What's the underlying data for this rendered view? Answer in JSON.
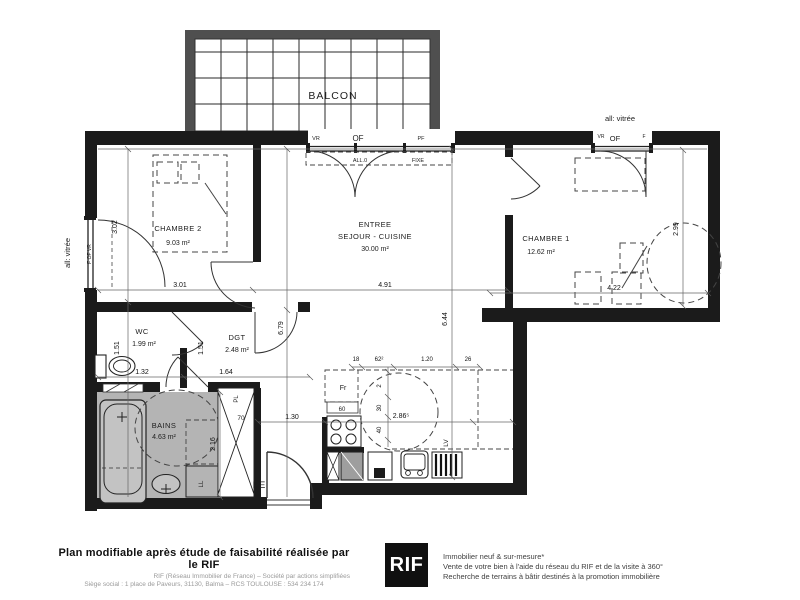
{
  "balcony": {
    "label": "BALCON"
  },
  "windows": {
    "main": {
      "vr": "VR",
      "of": "OF",
      "pf": "PF",
      "all0": "ALL.0",
      "fixe": "FIXE"
    },
    "ch1": {
      "note": "all: vitrée",
      "vr": "VR",
      "of": "OF",
      "f": "F"
    },
    "left": {
      "note": "all: vitrée",
      "labels": "F  OF  VR"
    }
  },
  "rooms": {
    "ch2": {
      "name": "CHAMBRE 2",
      "area": "9.03 m²",
      "w": "3.01",
      "h": "3.02"
    },
    "sejour": {
      "l1": "ENTREE",
      "l2": "SEJOUR - CUISINE",
      "area": "30.00 m²",
      "w": "4.91",
      "h": "6.44",
      "h2": "6.79"
    },
    "ch1": {
      "name": "CHAMBRE 1",
      "area": "12.62 m²",
      "w": "4.22",
      "h": "2.99"
    },
    "wc": {
      "name": "WC",
      "area": "1.99 m²",
      "w": "1.32",
      "h": "1.51"
    },
    "dgt": {
      "name": "DGT",
      "area": "2.48 m²",
      "w": "1.64",
      "h": "1.51"
    },
    "bains": {
      "name": "BAINS",
      "area": "4.63 m²",
      "h": "2.16"
    }
  },
  "kitchen": {
    "fridge": "Fr",
    "fridge_w": "60",
    "lv": "LV",
    "ll": "LL",
    "d18": "18",
    "d62": "62²",
    "d120": "1.20",
    "d26": "26",
    "d2": "2",
    "d30": "30",
    "d40": "40",
    "radius": "2.86⁵",
    "hall": "1.30"
  },
  "closet": {
    "pl": "PL",
    "w": "70"
  },
  "entry": {
    "pe": "PE"
  },
  "colors": {
    "wall": "#1b1b1b",
    "gray_room": "#b4b4b4",
    "balcony_frame": "#4f4f4f"
  },
  "footer": {
    "bold": "Plan modifiable après étude de faisabilité réalisée par le RIF",
    "sub1": "RIF (Réseau Immobilier de France) – Société par actions simplifiées",
    "sub2": "Siège social : 1 place de Paveurs, 31130, Balma – RCS TOULOUSE : 534 234 174",
    "logo": "RIF",
    "r1": "Immobilier neuf & sur-mesure*",
    "r2": "Vente de votre bien à l'aide du réseau du RIF et de la visite à 360°",
    "r3": "Recherche de terrains à bâtir destinés à la promotion immobilière"
  }
}
